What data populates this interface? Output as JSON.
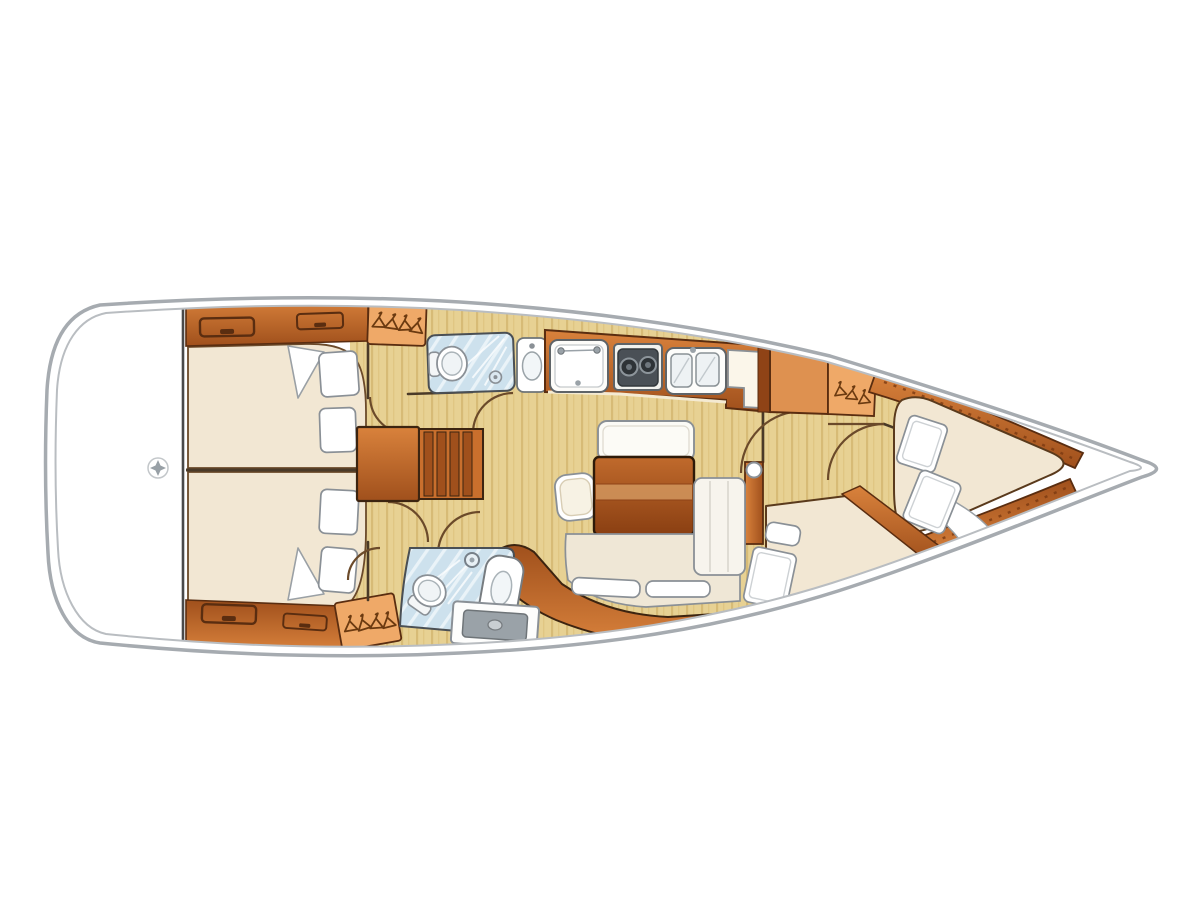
{
  "meta": {
    "type": "boat-interior-floorplan",
    "subject": "sailing-yacht-deck-plan-top-view-bow-right",
    "visible_text": []
  },
  "colors": {
    "background": "#ffffff",
    "hull_outline": "#a6abb0",
    "hull_inner_line": "#b9bdc1",
    "floor": "#e7d193",
    "head_floor": "#cde1ed",
    "mattress": "#f2e7d3",
    "cushion": "#efe7d6",
    "wood_light": "#d9823c",
    "wood_dark": "#a0501c",
    "wood_outline": "#5a2d10",
    "cabinet_orange": "#de9150",
    "locker_orange": "#efa968",
    "fixture_outline": "#777c80",
    "burner": "#2e3337",
    "appliance": "#9aa2a8",
    "pillow": "#ffffff",
    "divider": "#4a4a4a"
  },
  "layout": {
    "stern": {
      "name": "transom-platform",
      "items": [
        "compass-rose-icon",
        "centerline-divider"
      ]
    },
    "aft_cabin_top": {
      "name": "aft-cabin-top",
      "items": [
        "double-berth",
        "pillow",
        "pillow",
        "folded-sheet",
        "locker-band-2-handles",
        "hanging-locker"
      ]
    },
    "aft_cabin_bottom": {
      "name": "aft-cabin-bottom",
      "items": [
        "double-berth",
        "pillow",
        "pillow",
        "folded-sheet",
        "locker-band-2-handles",
        "hanging-locker"
      ]
    },
    "companionway": {
      "name": "companionway",
      "items": [
        "landing",
        "stairs-4-treads"
      ]
    },
    "head_top": {
      "name": "head-top",
      "items": [
        "toilet",
        "shower",
        "washbasin"
      ]
    },
    "galley": {
      "name": "galley",
      "items": [
        "sink-unit",
        "stove-2-burners",
        "double-sink",
        "counter-end-unit",
        "cabinet",
        "hanging-locker"
      ]
    },
    "salon": {
      "name": "salon",
      "items": [
        "stool",
        "bench",
        "folding-table",
        "l-shaped-settee",
        "chaise-cushions"
      ]
    },
    "head_bottom": {
      "name": "head-bottom",
      "items": [
        "toilet",
        "shower",
        "washbasin-column",
        "appliance-unit"
      ]
    },
    "forward_cabin": {
      "name": "forward-cabin",
      "items": [
        "v-berth",
        "pillow",
        "pillow",
        "angled-berth",
        "pillow",
        "blanket-roll",
        "wood-trim-top",
        "wood-trim-bottom"
      ]
    },
    "door_arcs": {
      "count": 7
    }
  }
}
